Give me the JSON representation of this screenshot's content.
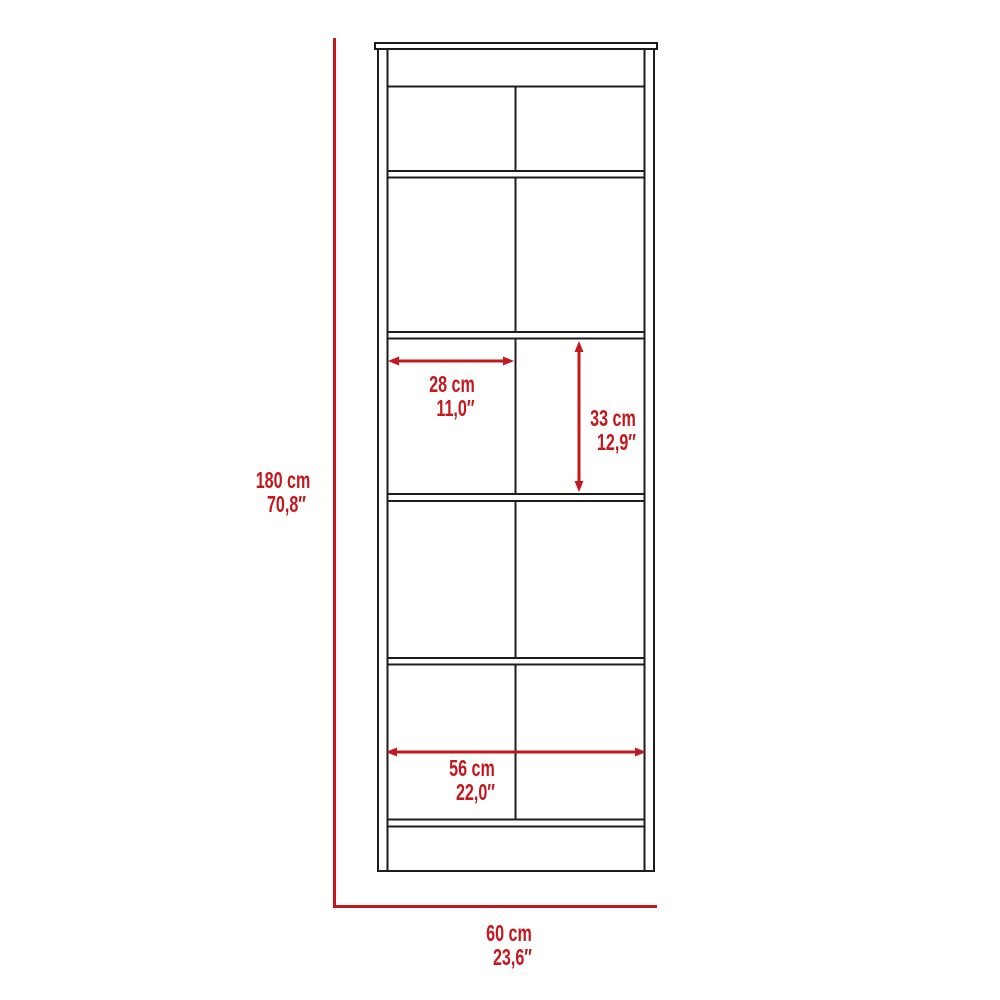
{
  "diagram": {
    "kind": "furniture-dimension-diagram",
    "subject": "tall storage cabinet with shelves, front view"
  },
  "colors": {
    "dimension_red": "#c3191e",
    "outline_black": "#1d1d1b",
    "page_bg": "#ffffff"
  },
  "labels": {
    "overall_height": {
      "cm": "180 cm",
      "inch": "70,8″"
    },
    "overall_width": {
      "cm": "60 cm",
      "inch": "23,6″"
    },
    "shelf_width": {
      "cm": "28 cm",
      "inch": "11,0″"
    },
    "shelf_height": {
      "cm": "33 cm",
      "inch": "12,9″"
    },
    "interior_width": {
      "cm": "56 cm",
      "inch": "22,0″"
    }
  }
}
